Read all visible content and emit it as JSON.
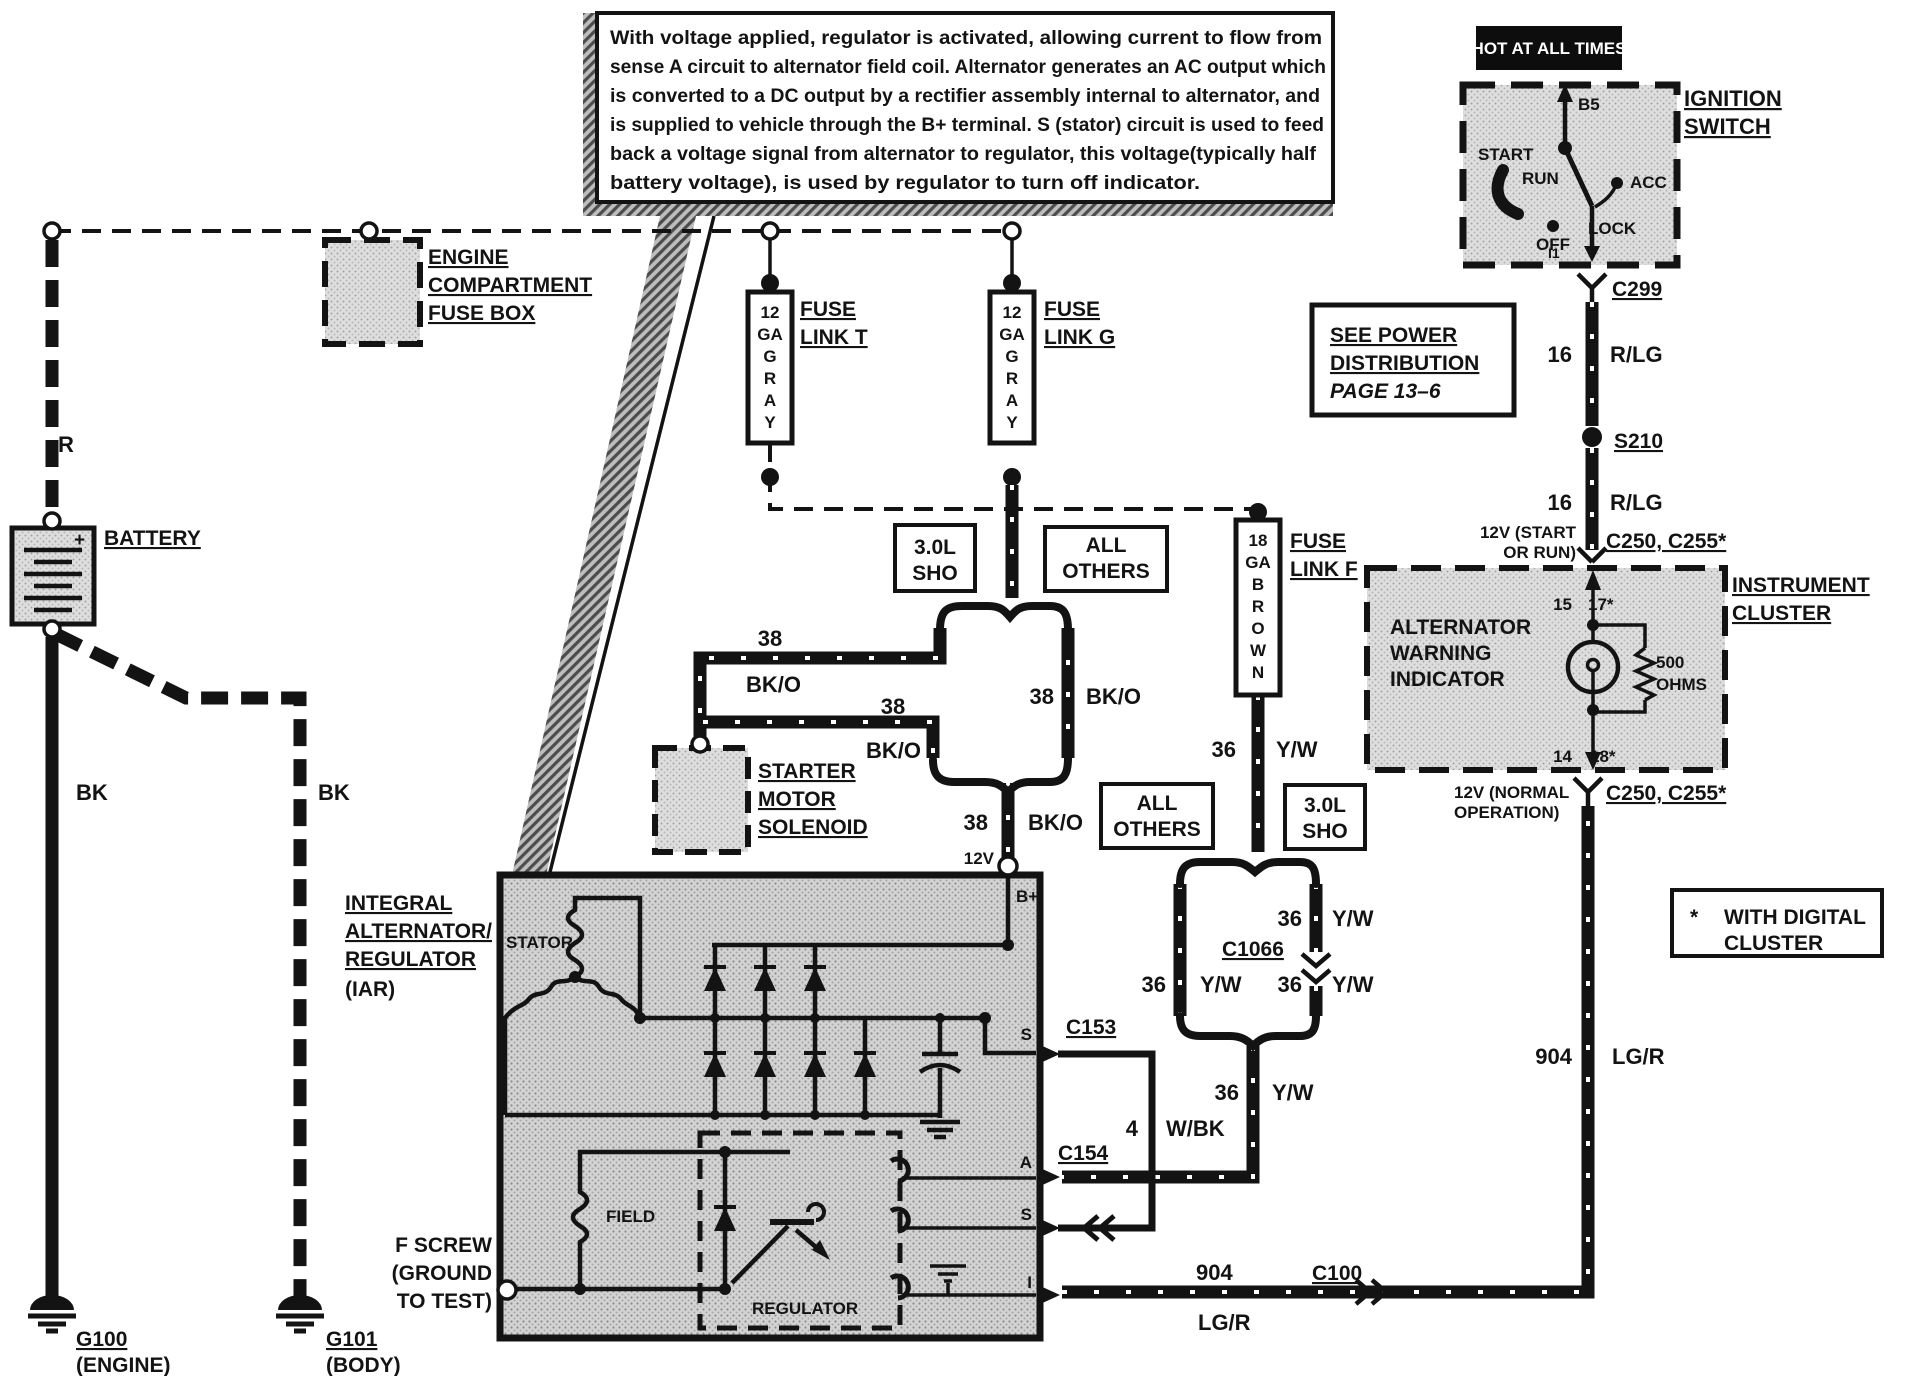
{
  "callout": {
    "lines": [
      "With voltage applied, regulator is activated, allowing current to flow from",
      "sense A circuit to alternator field coil. Alternator generates an AC output which",
      "is converted to a DC output by a rectifier assembly internal to alternator, and",
      "is supplied to vehicle through the B+ terminal. S (stator) circuit is used to feed",
      "back a voltage signal from alternator to regulator, this voltage(typically half",
      "battery voltage), is used by regulator to turn off indicator."
    ]
  },
  "hot_tag": "HOT AT ALL TIMES",
  "ignition": {
    "title": [
      "IGNITION",
      "SWITCH"
    ],
    "b5": "B5",
    "i1": "I1",
    "positions": {
      "start": "START",
      "run": "RUN",
      "off": "OFF",
      "lock": "LOCK",
      "acc": "ACC"
    }
  },
  "power_note": {
    "lines": [
      "SEE POWER",
      "DISTRIBUTION",
      "PAGE 13–6"
    ]
  },
  "engine_fuse_box": {
    "lines": [
      "ENGINE",
      "COMPARTMENT",
      "FUSE BOX"
    ]
  },
  "battery": {
    "label": "BATTERY",
    "plus": "+"
  },
  "grounds": {
    "g100": "G100",
    "g100_sub": "(ENGINE)",
    "g101": "G101",
    "g101_sub": "(BODY)"
  },
  "fuse_links": {
    "t": {
      "title": [
        "FUSE",
        "LINK T"
      ],
      "gauge": [
        "12",
        "GA",
        "G",
        "R",
        "A",
        "Y"
      ]
    },
    "g": {
      "title": [
        "FUSE",
        "LINK G"
      ],
      "gauge": [
        "12",
        "GA",
        "G",
        "R",
        "A",
        "Y"
      ]
    },
    "f": {
      "title": [
        "FUSE",
        "LINK F"
      ],
      "gauge": [
        "18",
        "GA",
        "B",
        "R",
        "O",
        "W",
        "N"
      ]
    }
  },
  "variants": {
    "sho": [
      "3.0L",
      "SHO"
    ],
    "others": [
      "ALL",
      "OTHERS"
    ]
  },
  "solenoid": {
    "lines": [
      "STARTER",
      "MOTOR",
      "SOLENOID"
    ]
  },
  "alternator": {
    "title": [
      "INTEGRAL",
      "ALTERNATOR/",
      "REGULATOR",
      "(IAR)"
    ],
    "stator": "STATOR",
    "field": "FIELD",
    "regulator": "REGULATOR",
    "f_screw": [
      "F SCREW",
      "(GROUND",
      "TO TEST)"
    ],
    "terminals": {
      "bplus": "B+",
      "s1": "S",
      "a": "A",
      "s2": "S",
      "i": "I"
    }
  },
  "cluster": {
    "title": [
      "INSTRUMENT",
      "CLUSTER"
    ],
    "indicator": [
      "ALTERNATOR",
      "WARNING",
      "INDICATOR"
    ],
    "resistor": [
      "500",
      "OHMS"
    ],
    "pins": {
      "p15": "15",
      "p17": "17*",
      "p14": "14",
      "p18": "18*"
    },
    "v12_start": [
      "12V (START",
      "OR RUN)"
    ],
    "v12_normal": [
      "12V (NORMAL",
      "OPERATION)"
    ]
  },
  "connectors": {
    "c299": "C299",
    "s210": "S210",
    "c250_top": "C250, C255*",
    "c250_bottom": "C250, C255*",
    "c1066": "C1066",
    "c153": "C153",
    "c154": "C154",
    "c100": "C100"
  },
  "wires": {
    "r": "R",
    "bk": "BK",
    "v12": "12V",
    "bko": {
      "gauge": "38",
      "color": "BK/O"
    },
    "yw": {
      "gauge": "36",
      "color": "Y/W"
    },
    "rlg": {
      "gauge": "16",
      "color": "R/LG"
    },
    "wbk": {
      "gauge": "4",
      "color": "W/BK"
    },
    "lgr": {
      "gauge": "904",
      "color": "LG/R"
    }
  },
  "digital_note": {
    "star": "*",
    "lines": [
      "WITH DIGITAL",
      "CLUSTER"
    ]
  }
}
